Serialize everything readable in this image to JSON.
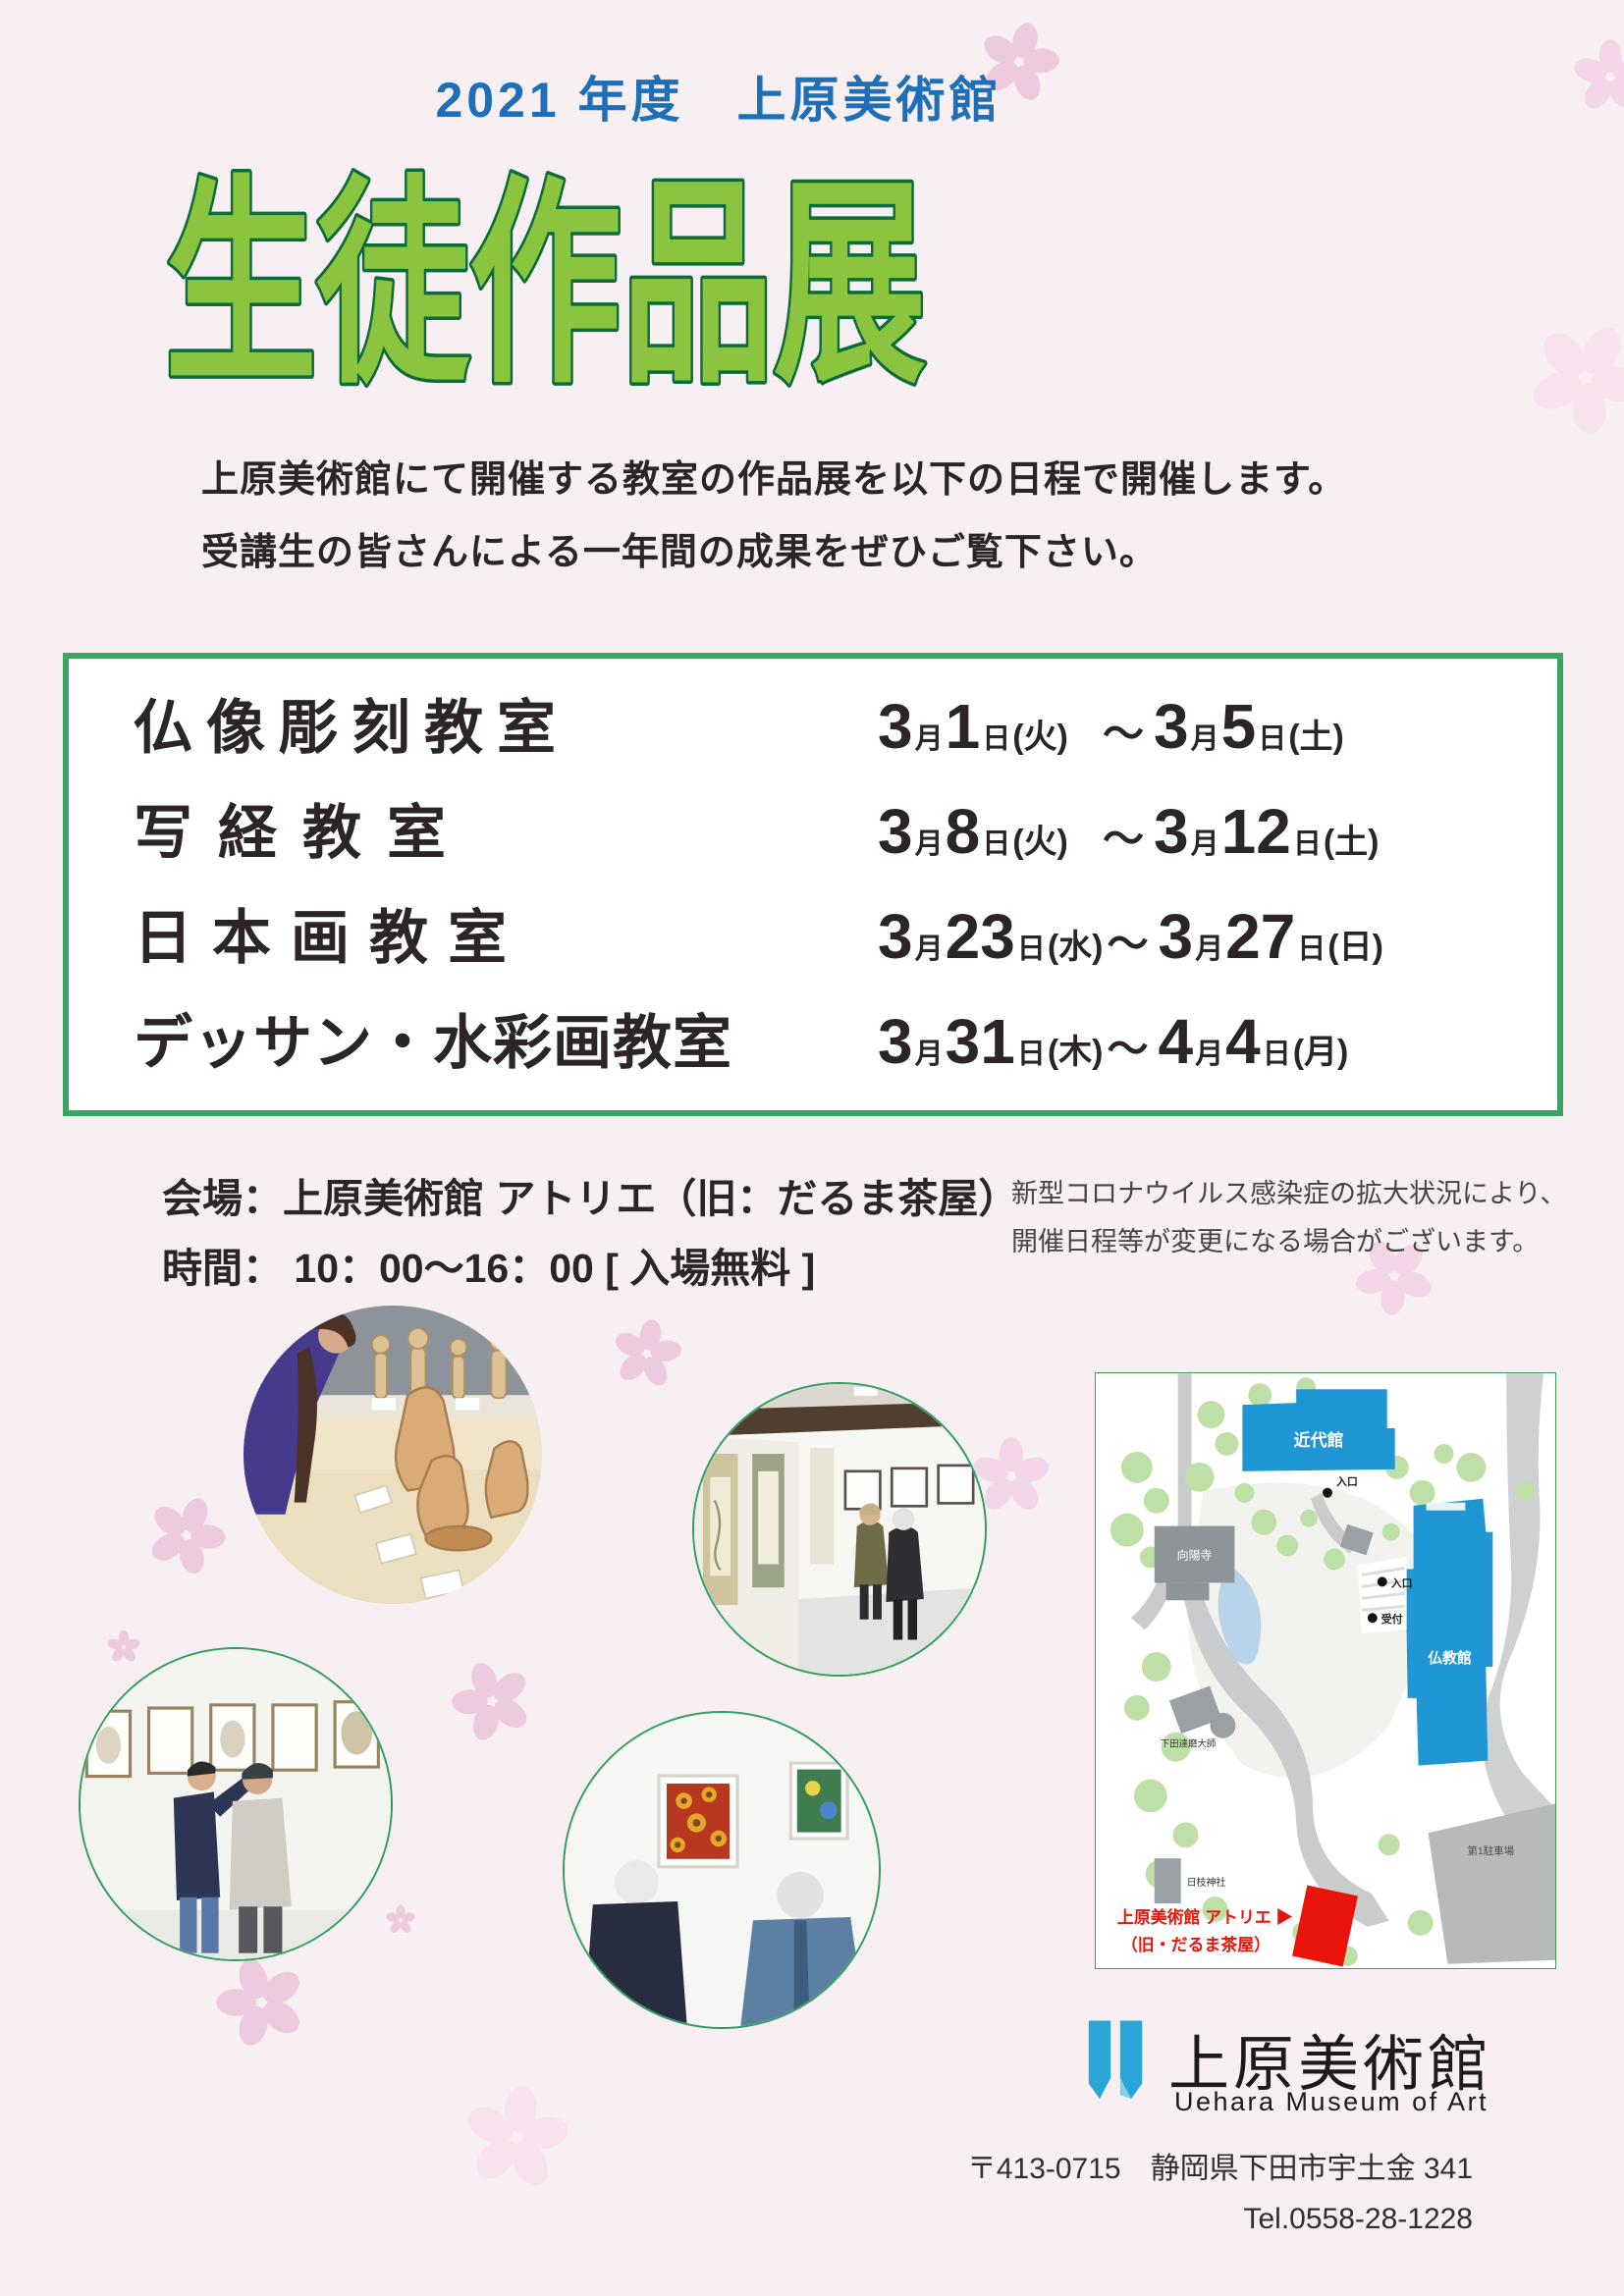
{
  "colors": {
    "background": "#f8eff3",
    "header_blue": "#1d6fb8",
    "title_green_fill": "#8bc53f",
    "title_green_stroke": "#0b6b39",
    "box_border_green": "#3aa562",
    "map_building_blue": "#1f97d4",
    "map_atelier_red": "#e8140a",
    "sakura_pink": "#eecade"
  },
  "header": {
    "year_line": "2021 年度　上原美術館",
    "title": "生徒作品展"
  },
  "intro": {
    "line1": "上原美術館にて開催する教室の作品展を以下の日程で開催します。",
    "line2": "受講生の皆さんによる一年間の成果をぜひご覧下さい。"
  },
  "schedule": {
    "units": {
      "month": "月",
      "day": "日",
      "tilde": "～"
    },
    "rows": [
      {
        "name": "仏像彫刻教室",
        "sm": "3",
        "sd": "1",
        "sw": "(火)",
        "em": "3",
        "ed": "5",
        "ew": "(土)"
      },
      {
        "name": "写経教室",
        "sm": "3",
        "sd": "8",
        "sw": "(火)",
        "em": "3",
        "ed": "12",
        "ew": "(土)"
      },
      {
        "name": "日本画教室",
        "sm": "3",
        "sd": "23",
        "sw": "(水)",
        "em": "3",
        "ed": "27",
        "ew": "(日)"
      },
      {
        "name": "デッサン・水彩画教室",
        "sm": "3",
        "sd": "31",
        "sw": "(木)",
        "em": "4",
        "ed": "4",
        "ew": "(月)"
      }
    ]
  },
  "venue": {
    "line1": "会場：上原美術館 アトリエ（旧：だるま茶屋）",
    "line2": "時間： 10：00～16：00 [ 入場無料 ]"
  },
  "notice": {
    "line1": "新型コロナウイルス感染症の拡大状況により、",
    "line2": "開催日程等が変更になる場合がございます。"
  },
  "map": {
    "labels": {
      "kindaikan": "近代館",
      "bukkyokan": "仏教館",
      "entrance1": "入口",
      "entrance2": "入口",
      "reception": "受付",
      "koyoji": "向陽寺",
      "daruma": "下田達磨大師",
      "hie_jinja": "日枝神社",
      "parking": "第1駐車場",
      "atelier_line1": "上原美術館 アトリエ ▶",
      "atelier_line2": "（旧・だるま茶屋）"
    }
  },
  "footer": {
    "museum_name": "上原美術館",
    "museum_name_en": "Uehara Museum of Art",
    "address": "〒413-0715　静岡県下田市宇土金 341",
    "tel": "Tel.0558-28-1228"
  }
}
